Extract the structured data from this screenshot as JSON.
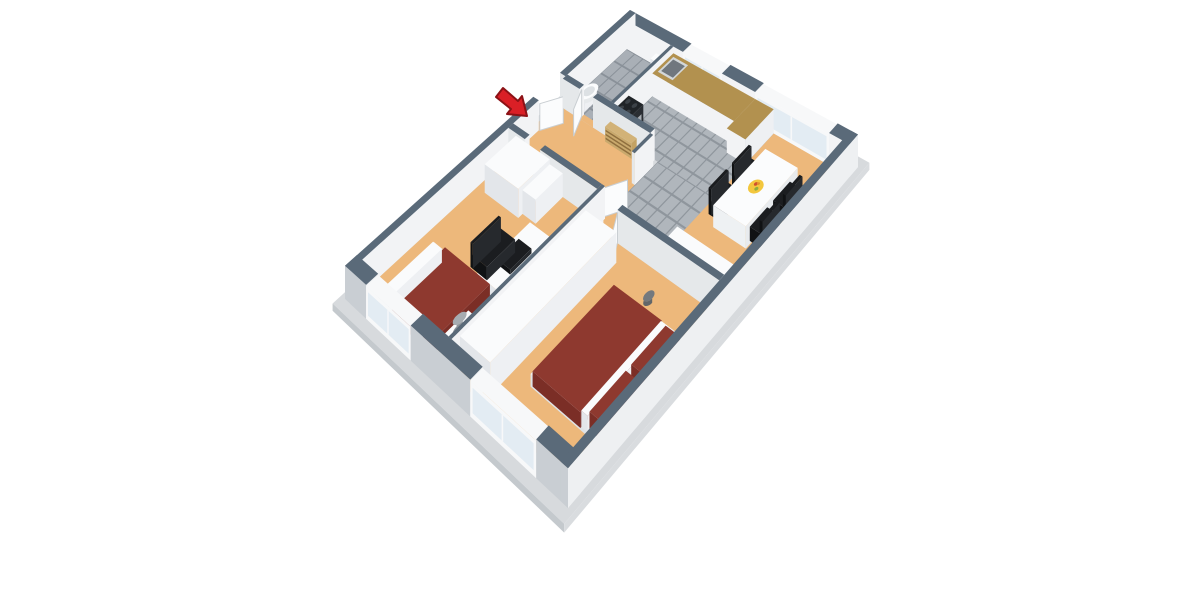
{
  "scene": {
    "kind": "3d-floor-plan-render",
    "view": "isometric-birdseye",
    "background": "#ffffff",
    "entrance_marker": "red-arrow"
  },
  "rooms": [
    {
      "id": "bathroom",
      "floor": "gray-tile",
      "fixtures": [
        "toilet",
        "pedestal-sink"
      ]
    },
    {
      "id": "kitchen",
      "floor": "gray-tile",
      "fixtures": [
        "counter-with-sink",
        "corner-counter",
        "stove-oven"
      ]
    },
    {
      "id": "hall",
      "floor": "orange-laminate",
      "fixtures": [
        "radiator",
        "entrance-door"
      ]
    },
    {
      "id": "living-dining",
      "floor": "orange-laminate",
      "fixtures": [
        "dining-table",
        "four-black-chairs",
        "fruit-plate",
        "sideboard"
      ]
    },
    {
      "id": "bedroom-small",
      "floor": "orange-laminate",
      "fixtures": [
        "single-bed",
        "wardrobe",
        "wardrobe-2",
        "nightstand",
        "table-lamp",
        "desk",
        "office-chair",
        "laptop"
      ]
    },
    {
      "id": "bedroom-master",
      "floor": "orange-laminate",
      "fixtures": [
        "double-bed",
        "pillows",
        "wardrobe",
        "small-floor-lamp"
      ]
    }
  ],
  "windows": [
    {
      "wall": "north-east",
      "room": "kitchen"
    },
    {
      "wall": "north-east",
      "room": "living-dining"
    },
    {
      "wall": "south-west",
      "room": "bedroom-small"
    },
    {
      "wall": "south-west",
      "room": "bedroom-master"
    }
  ],
  "doors": [
    {
      "id": "entrance",
      "wall": "north-west",
      "open": true
    },
    {
      "id": "bathroom-door",
      "open": true
    },
    {
      "id": "living-door",
      "open": true
    },
    {
      "id": "bedroom-small-door",
      "open": true
    },
    {
      "id": "bedroom-master-door",
      "open": true
    }
  ],
  "colors": {
    "wallTop": "#5a6a79",
    "extBright": "#eef0f2",
    "extGray": "#c9ced3",
    "intFaceU": "#f2f3f5",
    "intFaceV": "#e5e8ea",
    "slabTop": "#d7dadd",
    "slabSideU": "#d9dcdf",
    "slabSideV": "#c4c9cd",
    "floorOrange": "#edb87b",
    "tileGroutKitchen": "#8f969d",
    "tileBaseKitchen": "#b0b6bc",
    "tileGroutBath": "#8a9199",
    "tileBaseBath": "#a9afb6",
    "counterWood": "#b2914f",
    "radiatorWood": "#c9a96d",
    "radiatorStripe": "#8f6f3e",
    "bedRed": "#8e392f",
    "bedRedDark": "#7b2e26",
    "furnWhiteTop": "#fafbfc",
    "furnWhiteU": "#eef0f3",
    "furnWhiteV": "#e3e6ea",
    "blackTop": "#1b1d20",
    "blackU": "#26292d",
    "blackV": "#101214",
    "steelDark": "#70777e",
    "steelLight": "#d3d7d9",
    "windowWhite": "#f7f8f9",
    "glass": "#e3ecf3",
    "arrowRed": "#da1f26",
    "arrowDark": "#8c1216",
    "plateYellow": "#f3c73e",
    "plateEdge": "#e0a81f"
  }
}
